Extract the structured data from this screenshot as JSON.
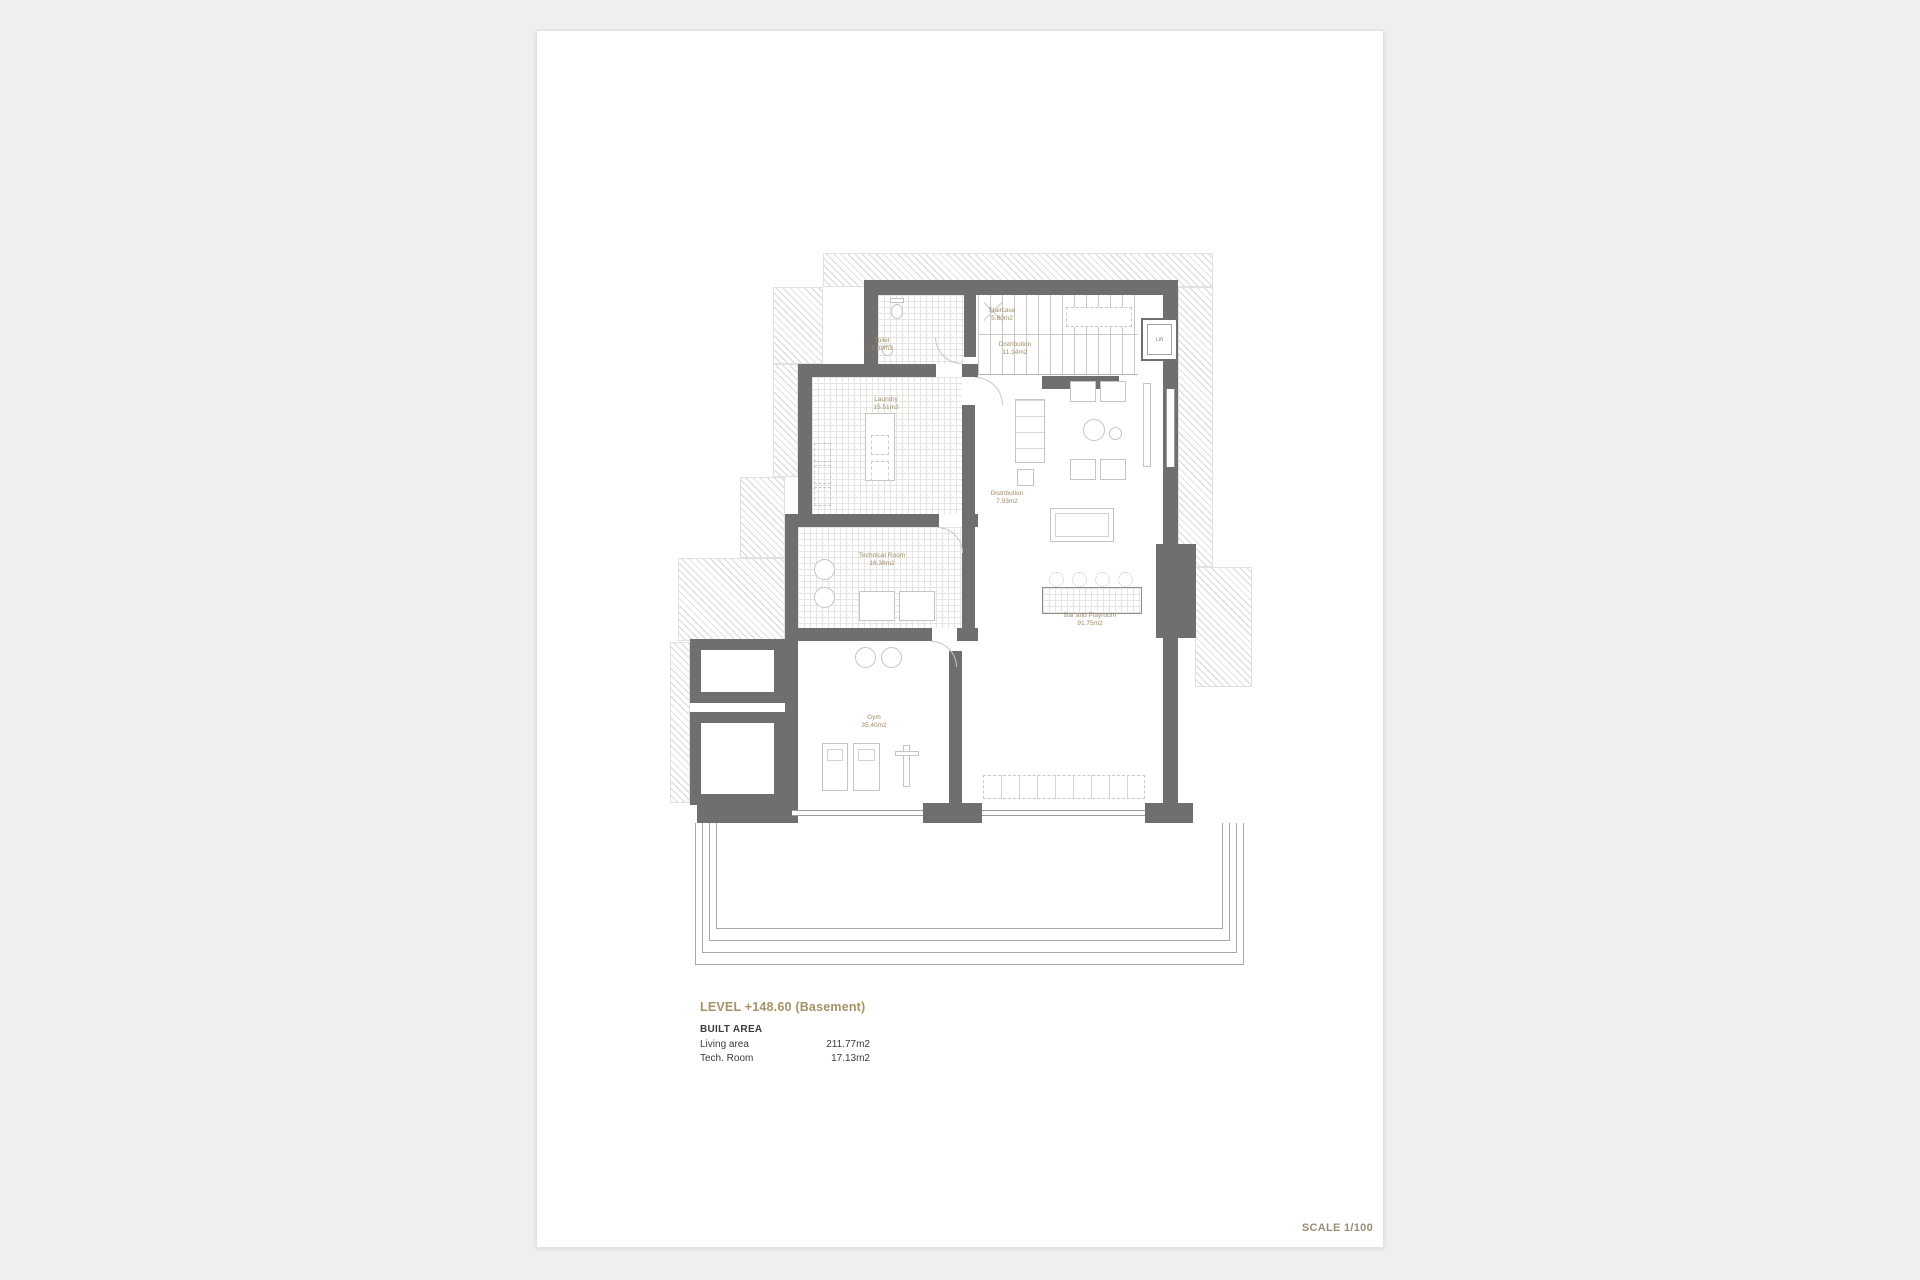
{
  "document": {
    "level_title": "LEVEL +148.60 (Basement)",
    "built_area_heading": "BUILT AREA",
    "areas": [
      {
        "label": "Living area",
        "value": "211.77m2"
      },
      {
        "label": "Tech. Room",
        "value": "17.13m2"
      }
    ],
    "scale": "SCALE 1/100"
  },
  "rooms": {
    "staircase": {
      "name": "Staircase",
      "area": "5.80m2"
    },
    "toilet": {
      "name": "Toilet",
      "area": "3.09m2"
    },
    "distribution_upper": {
      "name": "Distribution",
      "area": "11.14m2"
    },
    "lift": {
      "name": "Lift"
    },
    "laundry": {
      "name": "Laundry",
      "area": "15.51m2"
    },
    "distribution_lower": {
      "name": "Distribution",
      "area": "7.93m2"
    },
    "technical_room": {
      "name": "Technical Room",
      "area": "16.38m2"
    },
    "gym": {
      "name": "Gym",
      "area": "35.40m2"
    },
    "bar_playroom": {
      "name": "Bar and Playroom",
      "area": "91.75m2"
    }
  },
  "colors": {
    "wall": "#706f6d",
    "room_label": "#a08d6a",
    "level_title": "#a59365",
    "scale_label": "#9c8c74",
    "page_background": "#ffffff",
    "outer_background": "#f0efee"
  }
}
